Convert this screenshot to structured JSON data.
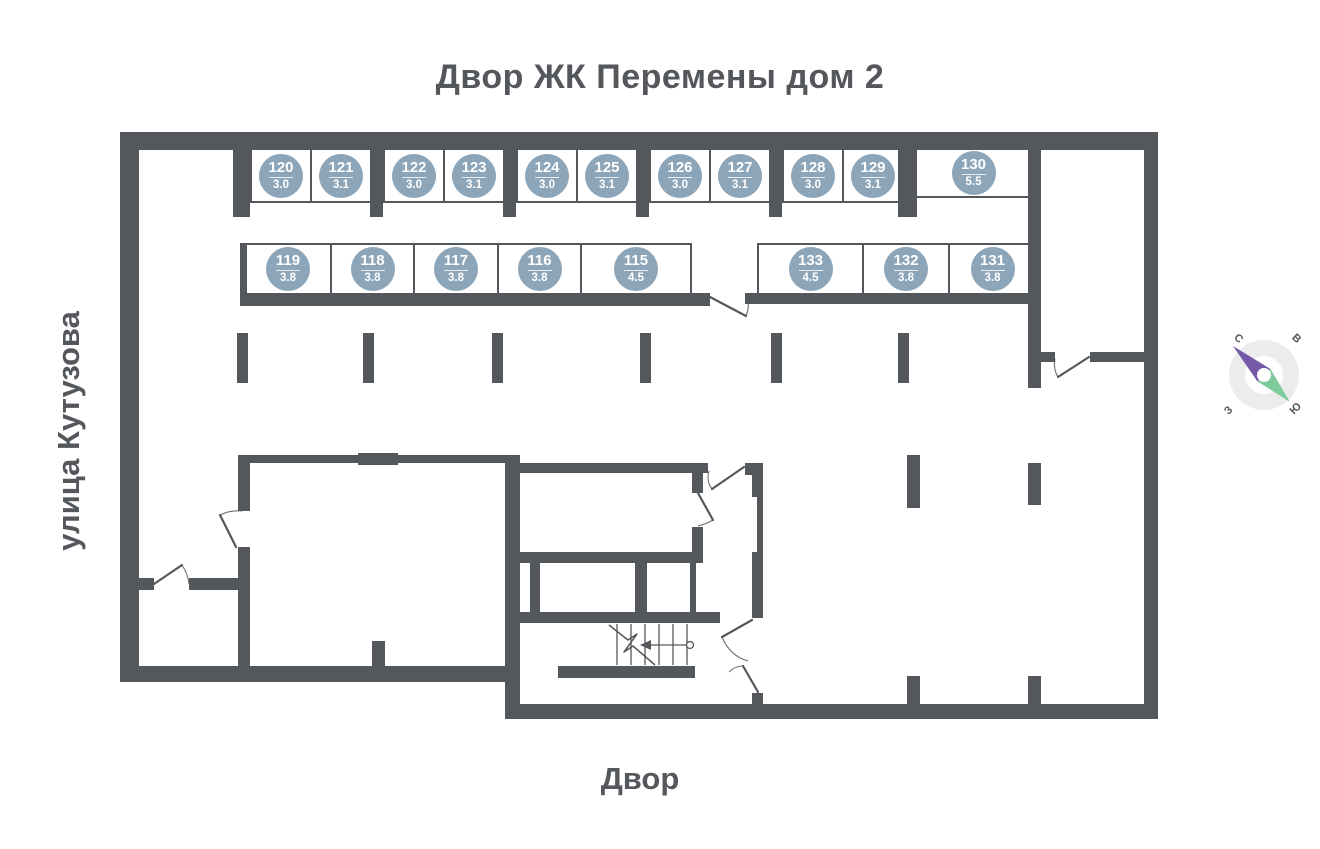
{
  "title": "Двор ЖК Перемены дом 2",
  "labels": {
    "street": "улица Кутузова",
    "yard": "Двор"
  },
  "compass": {
    "north": "С",
    "east": "В",
    "south": "Ю",
    "west": "З"
  },
  "colors": {
    "wall": "#54575b",
    "text": "#54575b",
    "badge": "#8ca5b9",
    "badge_text": "#ffffff",
    "compass_ring": "#ebecec",
    "compass_north": "#7459a8",
    "compass_south": "#7fcb9b"
  },
  "units": [
    {
      "number": "120",
      "area": "3.0"
    },
    {
      "number": "121",
      "area": "3.1"
    },
    {
      "number": "122",
      "area": "3.0"
    },
    {
      "number": "123",
      "area": "3.1"
    },
    {
      "number": "124",
      "area": "3.0"
    },
    {
      "number": "125",
      "area": "3.1"
    },
    {
      "number": "126",
      "area": "3.0"
    },
    {
      "number": "127",
      "area": "3.1"
    },
    {
      "number": "128",
      "area": "3.0"
    },
    {
      "number": "129",
      "area": "3.1"
    },
    {
      "number": "130",
      "area": "5.5"
    },
    {
      "number": "119",
      "area": "3.8"
    },
    {
      "number": "118",
      "area": "3.8"
    },
    {
      "number": "117",
      "area": "3.8"
    },
    {
      "number": "116",
      "area": "3.8"
    },
    {
      "number": "115",
      "area": "4.5"
    },
    {
      "number": "133",
      "area": "4.5"
    },
    {
      "number": "132",
      "area": "3.8"
    },
    {
      "number": "131",
      "area": "3.8"
    }
  ]
}
